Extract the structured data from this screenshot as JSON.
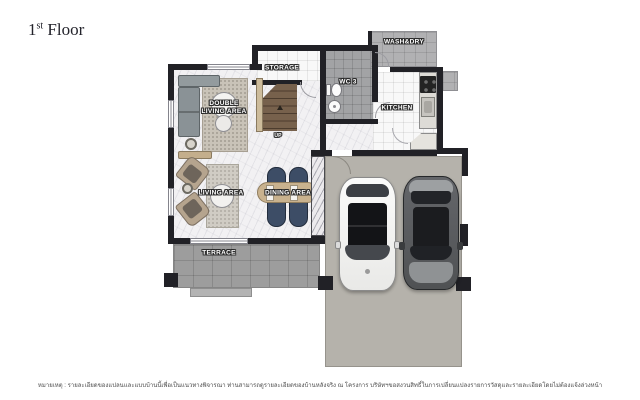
{
  "header": {
    "title_number": "1",
    "title_ordinal": "st",
    "title_text": " Floor"
  },
  "plan": {
    "rooms": {
      "double_living_area": {
        "line1": "DOUBLE",
        "line2": "LIVING AREA"
      },
      "storage": {
        "label": "STORAGE"
      },
      "wc3": {
        "label": "WC 3"
      },
      "wash_dry": {
        "label": "WASH&DRY"
      },
      "kitchen": {
        "label": "KITCHEN"
      },
      "living_area": {
        "label": "LIVING AREA"
      },
      "dining_area": {
        "label": "DINING AREA"
      },
      "terrace": {
        "label": "TERRACE"
      },
      "stairs": {
        "label": "UP"
      }
    },
    "garage": {
      "cars": [
        {
          "name": "white-car",
          "color": "#f5f5f4"
        },
        {
          "name": "gray-car",
          "color": "#56585a"
        }
      ]
    },
    "colors": {
      "wall": "#212126",
      "marble_floor": "#f2f1f3",
      "wc_tile": "#a2a3a5",
      "terrace_tile": "#9d9d9d",
      "garage_concrete": "#b5b2ab",
      "dining_chair_navy": "#3d4d66",
      "dining_table_tan": "#c9b28e",
      "stair_wood": "#6b5743",
      "sofa_gray": "#8a9296",
      "armchair_tan": "#b3a28f"
    }
  },
  "footer": {
    "note": "หมายเหตุ : รายละเอียดของแปลนและแบบบ้านนี้เพื่อเป็นแนวทางพิจารณา ท่านสามารถดูรายละเอียดของบ้านหลังจริง ณ โครงการ บริษัทฯขอสงวนสิทธิ์ในการเปลี่ยนแปลงรายการวัสดุและรายละเอียดโดยไม่ต้องแจ้งล่วงหน้า"
  }
}
